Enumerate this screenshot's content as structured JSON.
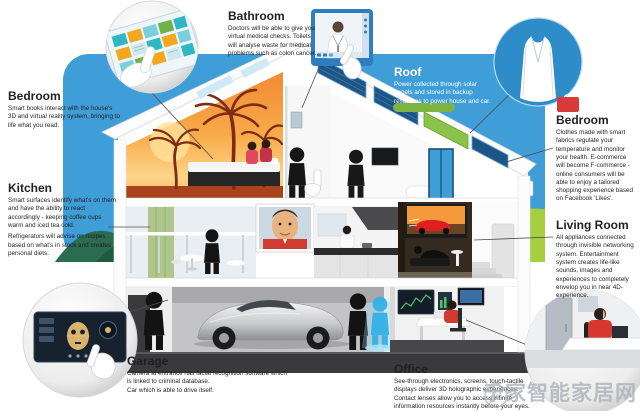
{
  "labels": {
    "bedroom_left": {
      "title": "Bedroom",
      "body": "Smart books interact with the house's 3D and virtual reality system, bringing to life what you read."
    },
    "kitchen": {
      "title": "Kitchen",
      "body1": "Smart surfaces identify what's on them and have the ability to react accordingly - keeping coffee cups warm and iced tea cold.",
      "body2": "Refrigerators will advise on recipes based on what's in stock and creates personal diets."
    },
    "bathroom": {
      "title": "Bathroom",
      "body": "Doctors will be able to give you virtual medical checks. Toilets will analyse waste for medical problems such as colon cancer."
    },
    "roof": {
      "title": "Roof",
      "body": "Power collected through solar panels and stored in backup resources to power house and car."
    },
    "bedroom_right": {
      "title": "Bedroom",
      "body": "Clothes made with smart fabrics regulate your temperature and monitor your health. E-commerce will become F-commerce - online consumers will be able to enjoy a tailored shopping experience based on Facebook 'Likes'."
    },
    "living_room": {
      "title": "Living Room",
      "body": "All appliances connected through invisible networking system. Entertainment system creates life-like sounds, images and experiences to completely envelop you in near 4D-experience."
    },
    "garage": {
      "title": "Garage",
      "body1": "Camera at entrance has facial recognition software which is linked to criminal database.",
      "body2": "Car which is able to drive itself."
    },
    "office": {
      "title": "Office",
      "body": "See-through electronics, screens, touch-tactile displays deliver 3D holographic experiences. Contact lenses allow you to access infinite information resources instantly before your eyes."
    }
  },
  "sign": {
    "line1": "PLUGNET",
    "line2": "ROAD"
  },
  "watermark": {
    "text": "千家智能家居网"
  },
  "callout_icons": [
    "smart-book-touchscreen-icon",
    "virtual-doctor-screen-icon",
    "smart-clothing-icon",
    "facial-recognition-scanner-icon",
    "home-office-scene-icon",
    "feather-logo-icon"
  ],
  "colors": {
    "sky": "#3f9dd8",
    "lawn": "#a5cf3e",
    "hill": "#2b6b50",
    "mural_orange": "#f28a33",
    "solar_panel": "#1d5686",
    "living_room_wall": "#352a1f",
    "foundation": "#3a3a3c",
    "accent_red": "#d8372f",
    "text": "#231f20"
  }
}
